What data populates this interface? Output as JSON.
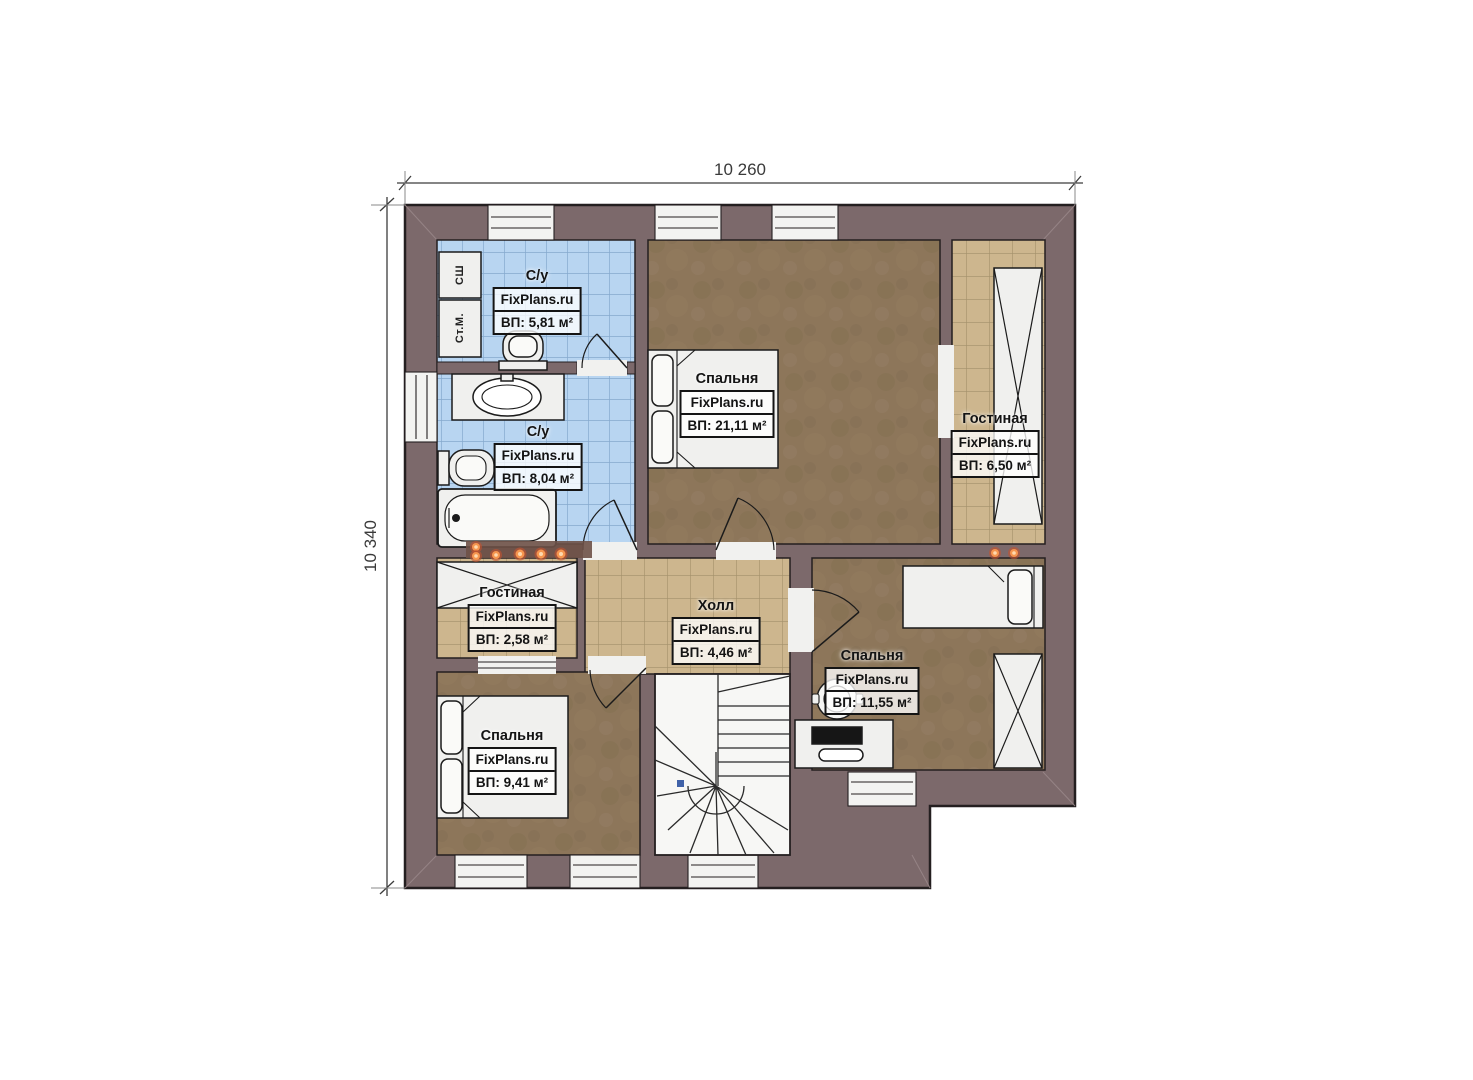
{
  "brand": "FixPlans.ru",
  "dimensions": {
    "top": "10 260",
    "left": "10 340"
  },
  "rooms": [
    {
      "name": "С/у",
      "area": "ВП: 5,81 м²"
    },
    {
      "name": "С/у",
      "area": "ВП: 8,04 м²"
    },
    {
      "name": "Спальня",
      "area": "ВП: 21,11 м²"
    },
    {
      "name": "Гостиная",
      "area": "ВП: 6,50 м²"
    },
    {
      "name": "Холл",
      "area": "ВП: 4,46 м²"
    },
    {
      "name": "Гостиная",
      "area": "ВП: 2,58 м²"
    },
    {
      "name": "Спальня",
      "area": "ВП: 11,55 м²"
    },
    {
      "name": "Спальня",
      "area": "ВП: 9,41 м²"
    }
  ],
  "closets": [
    {
      "label": "СШ"
    },
    {
      "label": "Ст.М."
    }
  ],
  "colors": {
    "wall": "#7c696b",
    "outline": "#241f20",
    "blue_tile": "#b8d5f1",
    "tan_tile": "#cdb68e",
    "wood_floor": "#8d765a",
    "radiator_dot": "#f08a47"
  }
}
